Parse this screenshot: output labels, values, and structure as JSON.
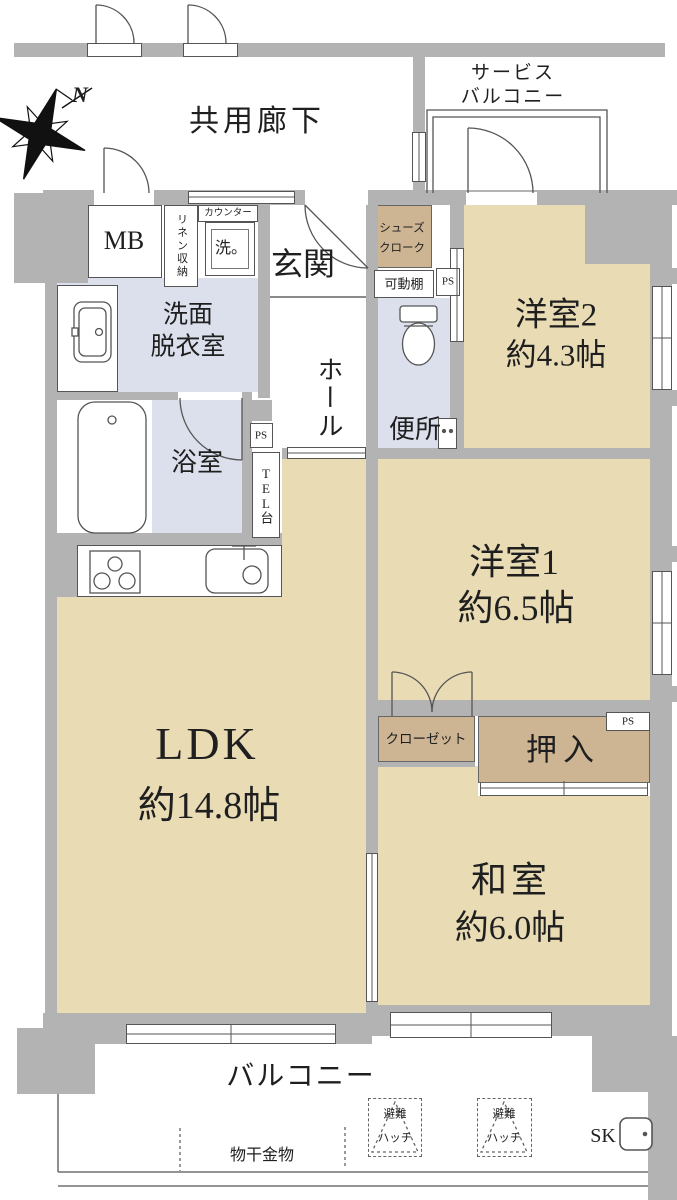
{
  "colors": {
    "room_tan": "#e9dcb5",
    "closet_tan": "#cdb493",
    "wet_area_blue": "#dce0ec",
    "wall_gray": "#b3b3b3",
    "line": "#4d4d4d"
  },
  "compass": {
    "north": "N"
  },
  "corridor": {
    "label": "共用廊下"
  },
  "service_balcony": {
    "line1": "サービス",
    "line2": "バルコニー"
  },
  "entrance": {
    "genkan": "玄関",
    "hall": "ホール",
    "shoes_line1": "シューズ",
    "shoes_line2": "クローク",
    "movable_shelf": "可動棚",
    "mb": "MB",
    "linen": "リネン収納",
    "counter": "カウンター",
    "washer": "洗。"
  },
  "sanitary": {
    "washroom_line1": "洗面",
    "washroom_line2": "脱衣室",
    "bath": "浴室",
    "toilet": "便所",
    "tel": "TEL台",
    "ps": "PS"
  },
  "rooms": {
    "room2": {
      "name": "洋室2",
      "size": "約4.3帖"
    },
    "room1": {
      "name": "洋室1",
      "size": "約6.5帖"
    },
    "ldk": {
      "name": "LDK",
      "size": "約14.8帖"
    },
    "washitsu": {
      "name": "和室",
      "size": "約6.0帖"
    },
    "closet": "クローゼット",
    "oshiire": "押入"
  },
  "balcony": {
    "label": "バルコニー",
    "hatch_line1": "避難",
    "hatch_line2": "ハッチ",
    "sk": "SK",
    "drying": "物干金物"
  }
}
